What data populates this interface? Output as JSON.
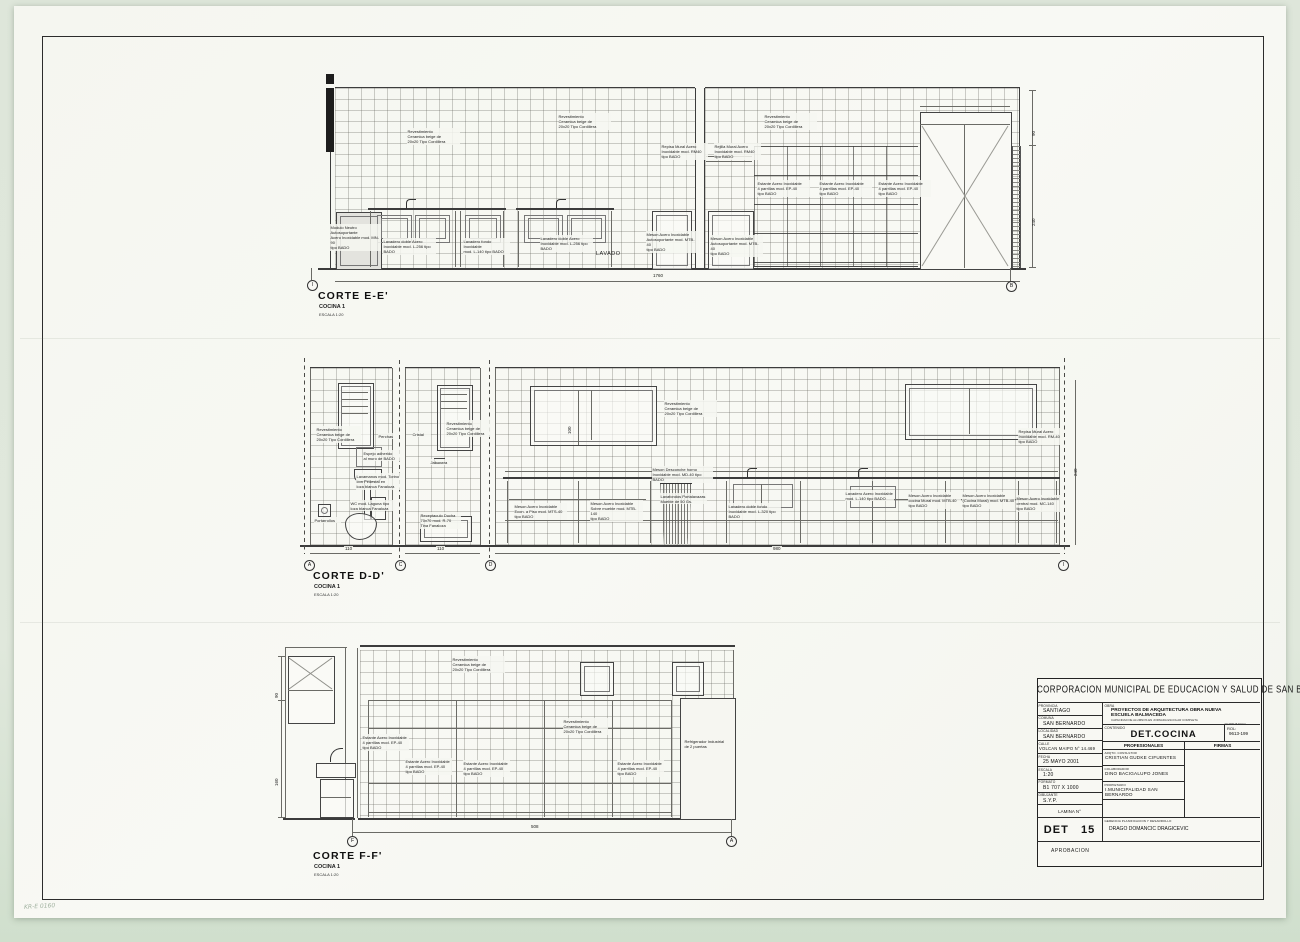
{
  "scan": {
    "handwritten_note": "KR-E 0160"
  },
  "sections": {
    "corte_e": {
      "title": "CORTE E-E'",
      "room": "COCINA 1",
      "scale": "ESCALA 1:20",
      "axis_start": "I",
      "axis_end": "B",
      "room_label": "LAVADO",
      "dim_total": "1760",
      "dims_right": [
        "90",
        "240"
      ],
      "annotations": [
        "Revestimiento\nCeramica beige de\n20x20 Tipo Cordillera",
        "Revestimiento\nCeramica beige de\n20x20 Tipo Cordillera",
        "Revestimiento\nCeramica beige de\n20x20 Tipo Cordillera",
        "Repisa Mural Acero\nInoxidable mod. RM40\ntipo BADO",
        "Rejilla Mural Acero\nInoxidable mod. RM40\ntipo BADO",
        "Estante Acero Inoxidable\n4 parrillas mod. EP-40\ntipo BADO",
        "Estante Acero Inoxidable\n4 parrillas mod. EP-40\ntipo BADO",
        "Estante Acero Inoxidable\n4 parrillas mod. EP-40\ntipo BADO",
        "Modulo Neutro Autosoportante\nAcero Inoxidable mod. MN-90\ntipo BADO",
        "Lavadero doble Acero\nInoxidable mod. L-256 tipo\nBADO",
        "Lavadero fondo Inoxidable\nmod. L-140 tipo BADO",
        "Lavadero doble Acero\nInoxidable mod. L-256 tipo\nBADO",
        "Meson Acero Inoxidable\nAutosoportante mod. MTB-40\ntipo BADO",
        "Meson Acero Inoxidable\nAutosoportante mod. MTB-40\ntipo BADO"
      ]
    },
    "corte_d": {
      "title": "CORTE D-D'",
      "room": "COCINA 1",
      "scale": "ESCALA 1:20",
      "axes": [
        "A",
        "C",
        "D",
        "I"
      ],
      "dims_bottom": [
        "110",
        "110",
        "980"
      ],
      "dim_right": "240",
      "dim_window": "100",
      "annotations": [
        "Revestimiento\nCeramica beige de\n20x20 Tipo Cordillera",
        "Revestimiento\nCeramica beige de\n20x20 Tipo Cordillera",
        "Revestimiento\nCeramica beige de\n20x20 Tipo Cordillera",
        "Repisa Mural Acero\nInoxidable mod. RM-40\ntipo BADO",
        "Perchas",
        "Cristal",
        "Espejo adherido\nal muro de BADO",
        "Jabonera",
        "Lavamanos mod. Torino\ncon Pedestal en\nloza blanca Fanaloza",
        "WC mod. Laguna tipo\nloza blanca Fanaloza",
        "Portarrollos",
        "Receptaculo Ducha\n70x70 mod. R-70\nTina Fanaloza",
        "Meson Desconche horno\nInoxidable mod. MD-40 tipo BADO",
        "Meson Acero Inoxidable\nEcon. a Piso mod. MTS-40\ntipo BADO",
        "Meson Acero Inoxidable\nSobre mueble mod. MTB-140\ntipo BADO",
        "Lavafondos Portalavazas\nMueble de 50 Gs.",
        "Lavadero doble fondo\nInoxidable mod. L-320 tipo\nBADO",
        "Lavadero Acero Inoxidable\nmod. L-140 tipo BADO",
        "Meson Acero Inoxidable\ncocina Mural mod. MTB-40\ntipo BADO",
        "Meson Acero Inoxidable\n(Cocina Mural) mod. MTB-40\ntipo BADO",
        "Meson Acero Inoxidable\ncentral mod. MC-140\ntipo BADO"
      ]
    },
    "corte_f": {
      "title": "CORTE F-F'",
      "room": "COCINA 1",
      "scale": "ESCALA 1:20",
      "axes": [
        "F",
        "A"
      ],
      "dim_total": "508",
      "dims_left": [
        "90",
        "160"
      ],
      "annotations": [
        "Revestimiento\nCeramica beige de\n20x20 Tipo Cordillera",
        "Revestimiento\nCeramica beige de\n20x20 Tipo Cordillera",
        "Estante Acero Inoxidable\n4 parrillas mod. EP-40\ntipo BADO",
        "Estante Acero Inoxidable\n4 parrillas mod. EP-40\ntipo BADO",
        "Estante Acero Inoxidable\n4 parrillas mod. EP-40\ntipo BADO",
        "Estante Acero Inoxidable\n4 parrillas mod. EP-40\ntipo BADO",
        "Refrigerador Industrial\nde 2 puertas"
      ]
    }
  },
  "titleblock": {
    "header": "CORPORACION MUNICIPAL DE EDUCACION Y SALUD DE SAN BERNARDO",
    "fields": [
      {
        "label": "PROVINCIA",
        "value": "SANTIAGO"
      },
      {
        "label": "COMUNA",
        "value": "SAN BERNARDO"
      },
      {
        "label": "LOCALIDAD",
        "value": "SAN BERNARDO"
      },
      {
        "label": "CALLE",
        "value": "VOLCAN MAIPO N° 14.469"
      },
      {
        "label": "FECHA",
        "value": "25 MAYO 2001"
      },
      {
        "label": "ESCALA",
        "value": "1:20"
      },
      {
        "label": "FORMATO",
        "value": "B1 707 X 1000"
      },
      {
        "label": "DIBUJANTE",
        "value": "S.Y.P."
      }
    ],
    "obra_label": "OBRA",
    "obra_line1": "PROYECTOS DE ARQUITECTURA OBRA NUEVA",
    "obra_line2": "ESCUELA BALMACEDA",
    "obra_line3": "CAPACIDAD DE ALUMNOS EN JORNADA ESCOLAR COMPLETA",
    "obra_line4": "N° PRE BASICA",
    "contenido_label": "CONTENIDO",
    "contenido": "DET.COCINA",
    "rol_label": "ROL:",
    "rol": "9613-199",
    "profesionales": "PROFESIONALES",
    "firmas": "FIRMAS",
    "rows": [
      {
        "label": "ARQTO. CONSULTOR",
        "value": "CRISTIAN GUDKE CIFUENTES"
      },
      {
        "label": "COLABORADOR",
        "value": "DINO BACIGALUPO JONES"
      },
      {
        "label": "PROPIETARIO",
        "value": "I.MUNICIPALIDAD SAN BERNARDO"
      }
    ],
    "lamina_label": "LAMINA N°",
    "lamina": "DET   15",
    "gerencia_label": "GERENCIA PLANIFICACION Y DESARROLLO",
    "gerencia": "DRAGO DOMANCIC DRAGICEVIC",
    "aprobacion": "APROBACION"
  }
}
